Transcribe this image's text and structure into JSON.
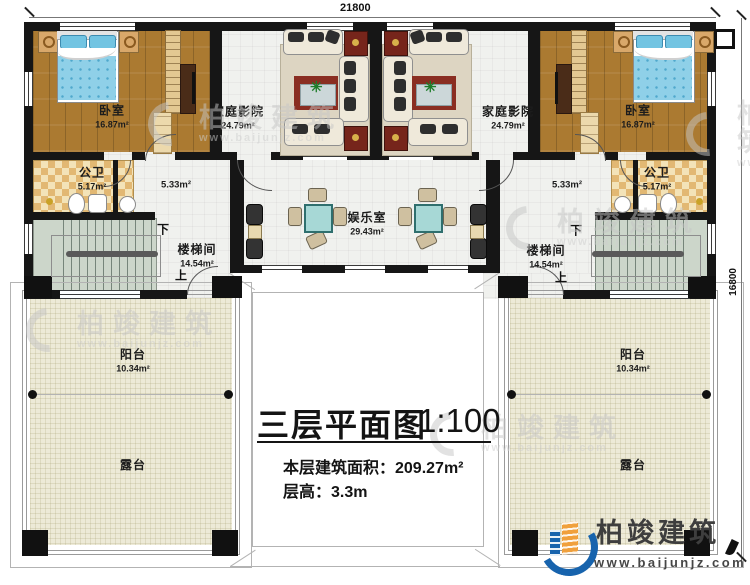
{
  "dimensions": {
    "top": "21800",
    "right": "16800"
  },
  "title": {
    "main": "三层平面图",
    "scale": "1:100",
    "area_line": "本层建筑面积：209.27m²",
    "height_line": "层高：3.3m"
  },
  "brand": {
    "name": "柏竣建筑",
    "url": "www.baijunjz.com"
  },
  "watermark": {
    "name": "柏竣建筑",
    "url": "www.baijunjz.com"
  },
  "rooms": {
    "bedroom_left": {
      "name": "卧室",
      "area": "16.87m²"
    },
    "theater_left": {
      "name": "家庭影院",
      "area": "24.79m²"
    },
    "theater_right": {
      "name": "家庭影院",
      "area": "24.79m²"
    },
    "bedroom_right": {
      "name": "卧室",
      "area": "16.87m²"
    },
    "bath_left": {
      "name": "公卫",
      "area": "5.17m²"
    },
    "bath_right": {
      "name": "公卫",
      "area": "5.17m²"
    },
    "hall_left": {
      "area": "5.33m²"
    },
    "hall_right": {
      "area": "5.33m²"
    },
    "stair_left": {
      "name": "楼梯间",
      "area": "14.54m²",
      "down": "下",
      "up": "上"
    },
    "stair_right": {
      "name": "楼梯间",
      "area": "14.54m²",
      "down": "下",
      "up": "上"
    },
    "game_room": {
      "name": "娱乐室",
      "area": "29.43m²"
    },
    "balcony_left": {
      "name": "阳台",
      "area": "10.34m²"
    },
    "balcony_right": {
      "name": "阳台",
      "area": "10.34m²"
    },
    "terrace_left": {
      "name": "露台"
    },
    "terrace_right": {
      "name": "露台"
    }
  },
  "colors": {
    "wall": "#161616",
    "wood_floor": "#ab7a31",
    "bath_tile": "#e2b873",
    "stair_floor": "#ccd6ca",
    "terrace_floor": "#edead7",
    "table_teal": "#a7d8d6",
    "tv_panel_red": "#76251b",
    "bed_blue": "#8fd0e8",
    "brand_blue": "#1763ad",
    "brand_orange": "#f0a03c",
    "watermark_gray": "#c9c9c9"
  }
}
